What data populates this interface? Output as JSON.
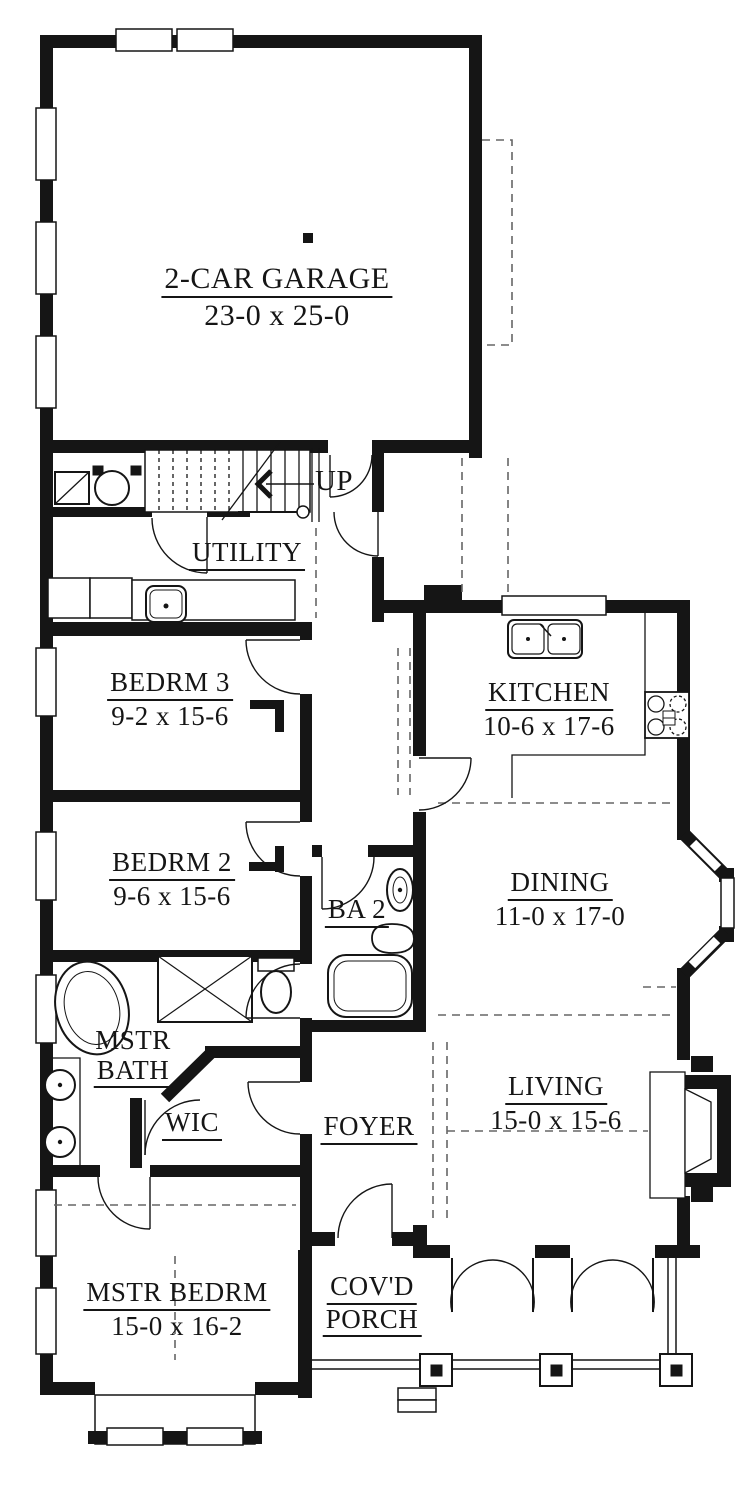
{
  "plan": {
    "colors": {
      "ink": "#151515",
      "background": "#ffffff",
      "dash": "#666666"
    },
    "rooms": {
      "garage": {
        "name": "2-CAR GARAGE",
        "dims": "23-0 x 25-0"
      },
      "utility": {
        "name": "UTILITY"
      },
      "bedrm3": {
        "name": "BEDRM 3",
        "dims": "9-2 x 15-6"
      },
      "kitchen": {
        "name": "KITCHEN",
        "dims": "10-6 x 17-6"
      },
      "bedrm2": {
        "name": "BEDRM 2",
        "dims": "9-6 x 15-6"
      },
      "ba2": {
        "name": "BA 2"
      },
      "dining": {
        "name": "DINING",
        "dims": "11-0 x 17-0"
      },
      "mstr_bath": {
        "line1": "MSTR",
        "line2": "BATH"
      },
      "wic": {
        "name": "WIC"
      },
      "foyer": {
        "name": "FOYER"
      },
      "living": {
        "name": "LIVING",
        "dims": "15-0 x 15-6"
      },
      "mstr_bedrm": {
        "name": "MSTR BEDRM",
        "dims": "15-0 x 16-2"
      },
      "porch": {
        "line1": "COV'D",
        "line2": "PORCH"
      }
    },
    "stairs": {
      "label": "UP"
    }
  }
}
